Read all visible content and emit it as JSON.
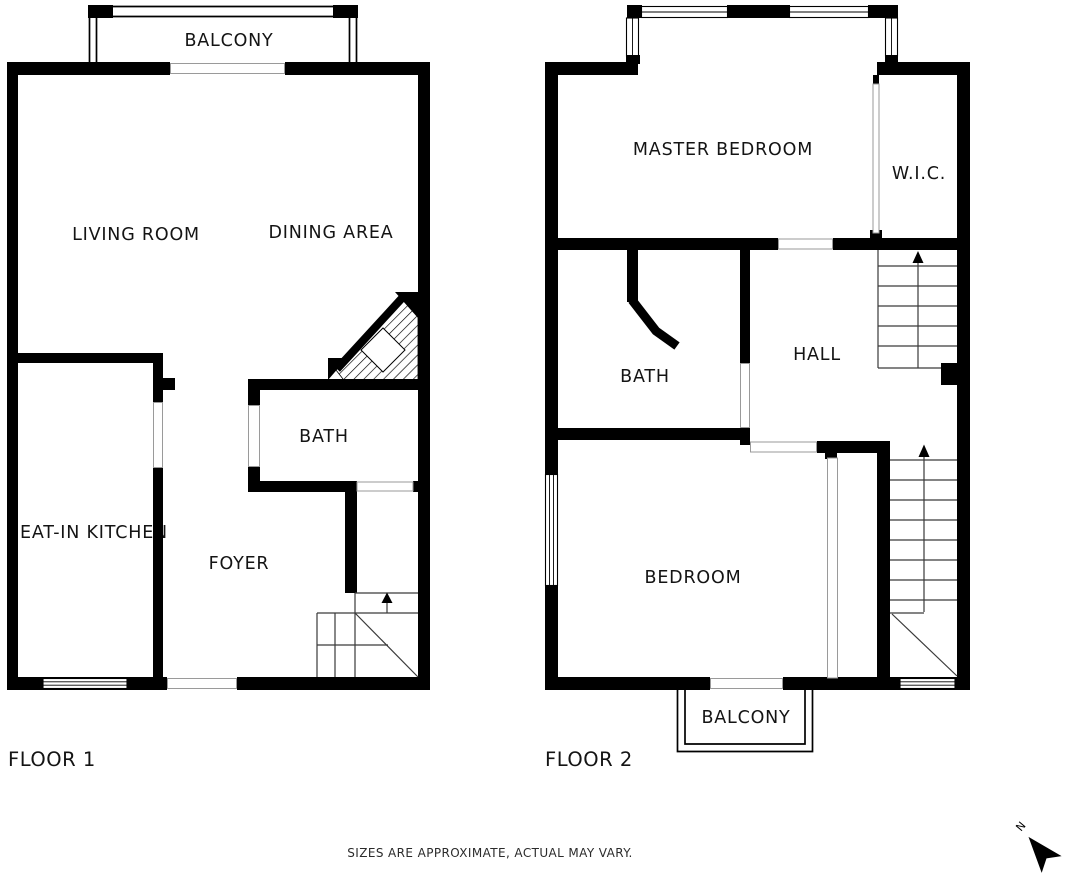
{
  "floor1": {
    "title": "FLOOR 1",
    "rooms": {
      "balcony": "BALCONY",
      "living_room": "LIVING ROOM",
      "dining_area": "DINING AREA",
      "bath": "BATH",
      "eat_in_kitchen": "EAT-IN KITCHEN",
      "foyer": "FOYER"
    }
  },
  "floor2": {
    "title": "FLOOR 2",
    "rooms": {
      "master_bedroom": "MASTER BEDROOM",
      "wic": "W.I.C.",
      "bath": "BATH",
      "hall": "HALL",
      "bedroom": "BEDROOM",
      "balcony": "BALCONY"
    }
  },
  "footer": {
    "disclaimer": "SIZES ARE APPROXIMATE, ACTUAL MAY VARY."
  },
  "compass": {
    "north_label": "N"
  },
  "colors": {
    "wall": "#000000",
    "background": "#ffffff",
    "stair_line": "#3a3a3a",
    "threshold_line": "#9a9a9a"
  }
}
